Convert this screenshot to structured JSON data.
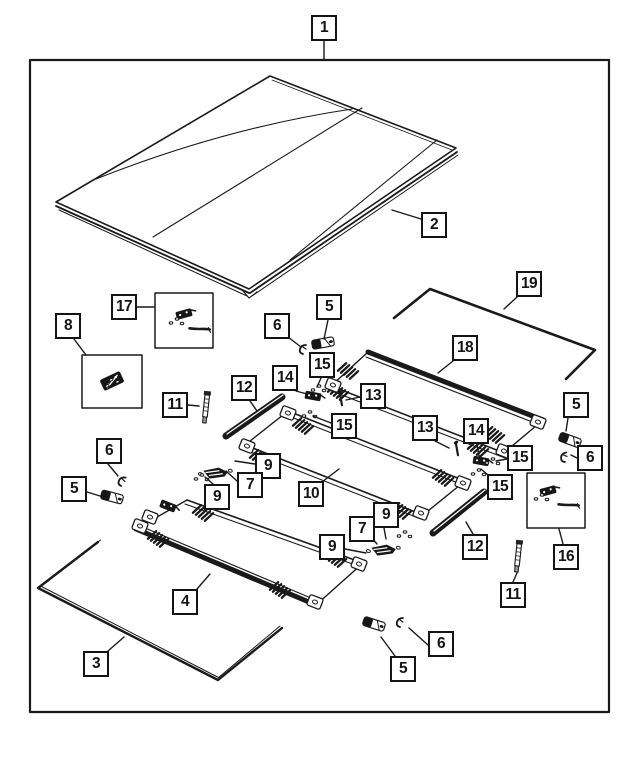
{
  "diagram": {
    "kind": "exploded-parts-diagram",
    "colors": {
      "background": "#ffffff",
      "line": "#1a1a1a",
      "fill_dark": "#161616"
    }
  },
  "callouts": [
    {
      "name": "callout-1",
      "label": "1"
    },
    {
      "name": "callout-2",
      "label": "2"
    },
    {
      "name": "callout-17",
      "label": "17"
    },
    {
      "name": "callout-8",
      "label": "8"
    },
    {
      "name": "callout-6-upper-left",
      "label": "6"
    },
    {
      "name": "callout-5-top",
      "label": "5"
    },
    {
      "name": "callout-15-top",
      "label": "15"
    },
    {
      "name": "callout-14-left",
      "label": "14"
    },
    {
      "name": "callout-13-left",
      "label": "13"
    },
    {
      "name": "callout-15-mid-left",
      "label": "15"
    },
    {
      "name": "callout-12-left",
      "label": "12"
    },
    {
      "name": "callout-11-left",
      "label": "11"
    },
    {
      "name": "callout-18",
      "label": "18"
    },
    {
      "name": "callout-19",
      "label": "19"
    },
    {
      "name": "callout-13-right",
      "label": "13"
    },
    {
      "name": "callout-14-right",
      "label": "14"
    },
    {
      "name": "callout-15-right-upper",
      "label": "15"
    },
    {
      "name": "callout-15-right-lower",
      "label": "15"
    },
    {
      "name": "callout-5-right",
      "label": "5"
    },
    {
      "name": "callout-6-right",
      "label": "6"
    },
    {
      "name": "callout-16",
      "label": "16"
    },
    {
      "name": "callout-12-right",
      "label": "12"
    },
    {
      "name": "callout-11-right",
      "label": "11"
    },
    {
      "name": "callout-6-left",
      "label": "6"
    },
    {
      "name": "callout-5-left",
      "label": "5"
    },
    {
      "name": "callout-9-left-top",
      "label": "9"
    },
    {
      "name": "callout-7-left",
      "label": "7"
    },
    {
      "name": "callout-9-left-bottom",
      "label": "9"
    },
    {
      "name": "callout-10",
      "label": "10"
    },
    {
      "name": "callout-9-right-top",
      "label": "9"
    },
    {
      "name": "callout-7-right",
      "label": "7"
    },
    {
      "name": "callout-9-right-bottom",
      "label": "9"
    },
    {
      "name": "callout-4",
      "label": "4"
    },
    {
      "name": "callout-3",
      "label": "3"
    },
    {
      "name": "callout-5-bottom",
      "label": "5"
    },
    {
      "name": "callout-6-bottom",
      "label": "6"
    }
  ]
}
